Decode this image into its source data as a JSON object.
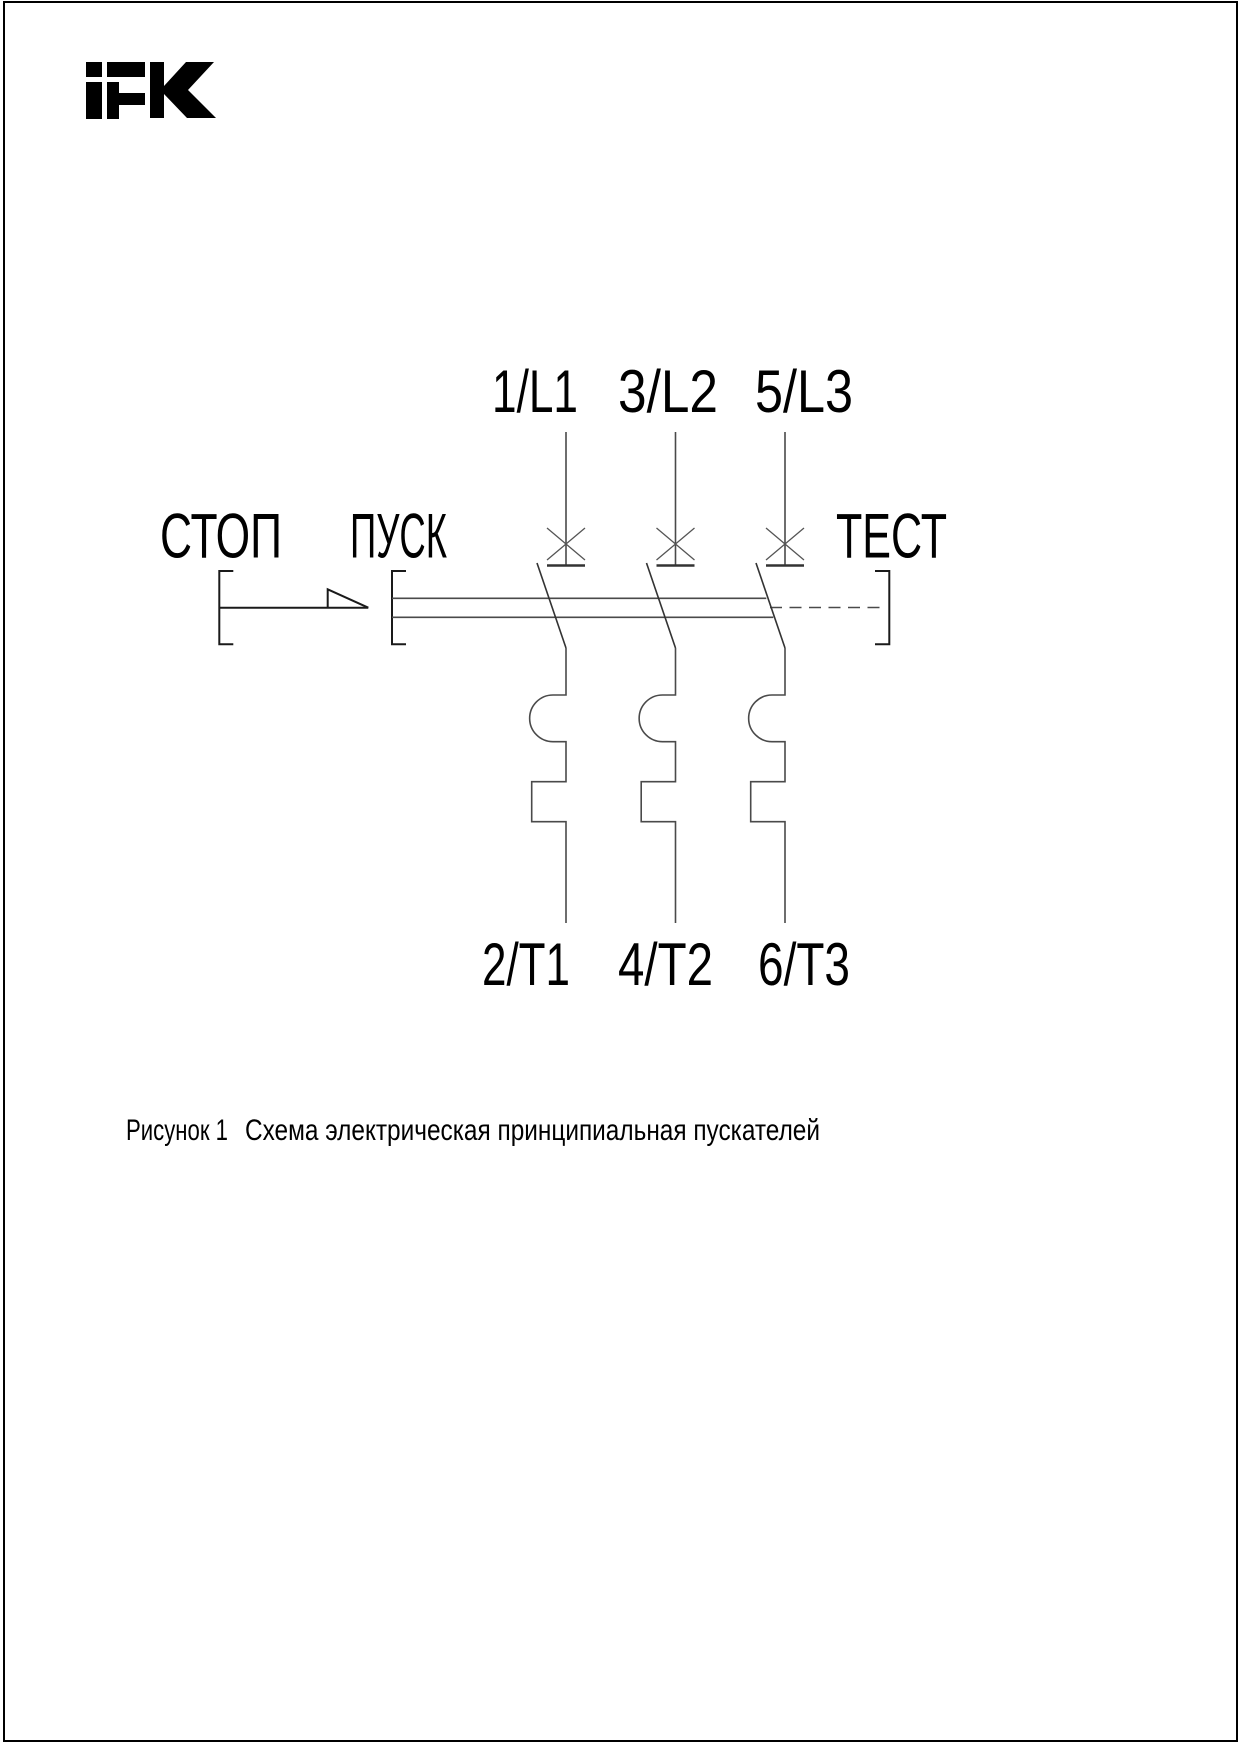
{
  "logo": {
    "brand": "IEK"
  },
  "diagram": {
    "stop_label": "СТОП",
    "start_label": "ПУСК",
    "test_label": "ТЕСТ",
    "top_terminals": [
      "1/L1",
      "3/L2",
      "5/L3"
    ],
    "bottom_terminals": [
      "2/T1",
      "4/T2",
      "6/T3"
    ]
  },
  "caption": {
    "number": "Рисунок 1",
    "text": "Схема электрическая принципиальная пускателей"
  },
  "colors": {
    "line": "#4a4a4a",
    "text": "#000000",
    "background": "#ffffff",
    "border": "#000000"
  }
}
